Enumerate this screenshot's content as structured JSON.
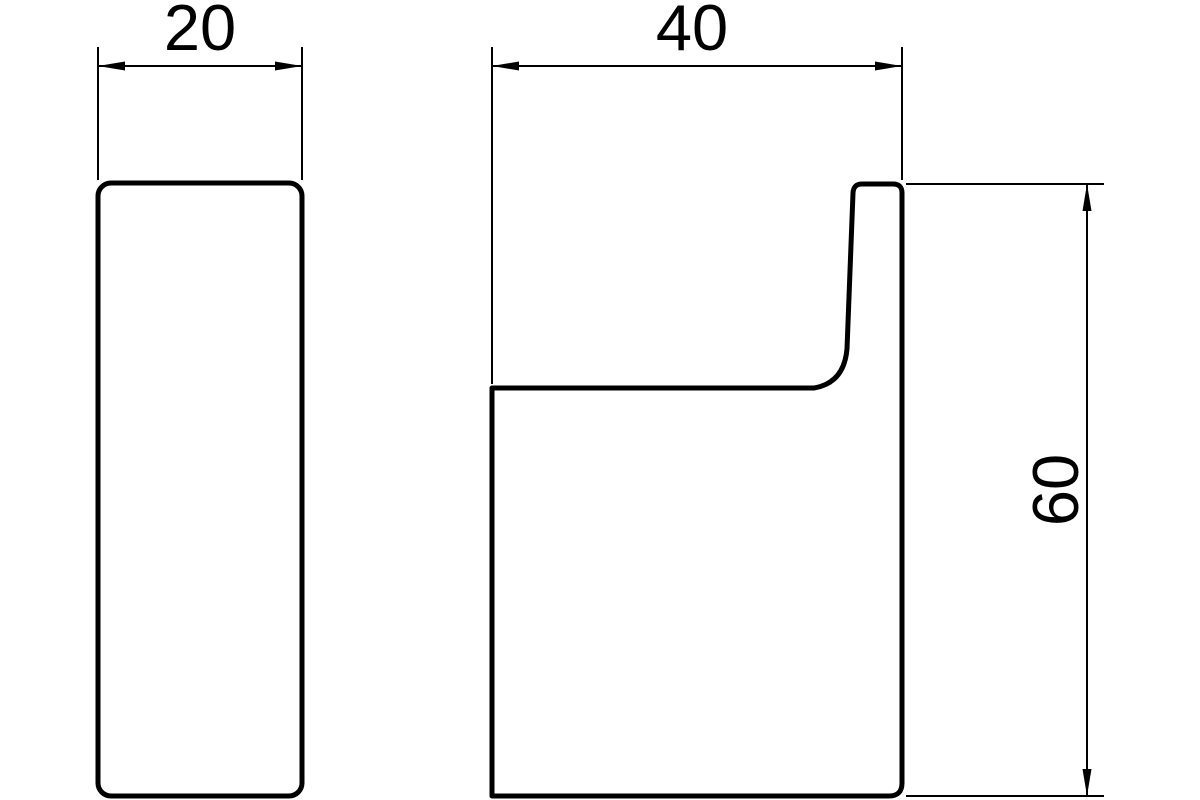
{
  "colors": {
    "line": "#000000",
    "background": "#ffffff"
  },
  "drawing": {
    "type": "technical-dimension-drawing",
    "views": {
      "front": {
        "name": "front view (hook seen from front)"
      },
      "side": {
        "name": "side view (hook profile)"
      }
    },
    "dimensions": {
      "front_width": {
        "label": "20"
      },
      "side_depth": {
        "label": "40"
      },
      "side_height": {
        "label": "60"
      }
    }
  }
}
